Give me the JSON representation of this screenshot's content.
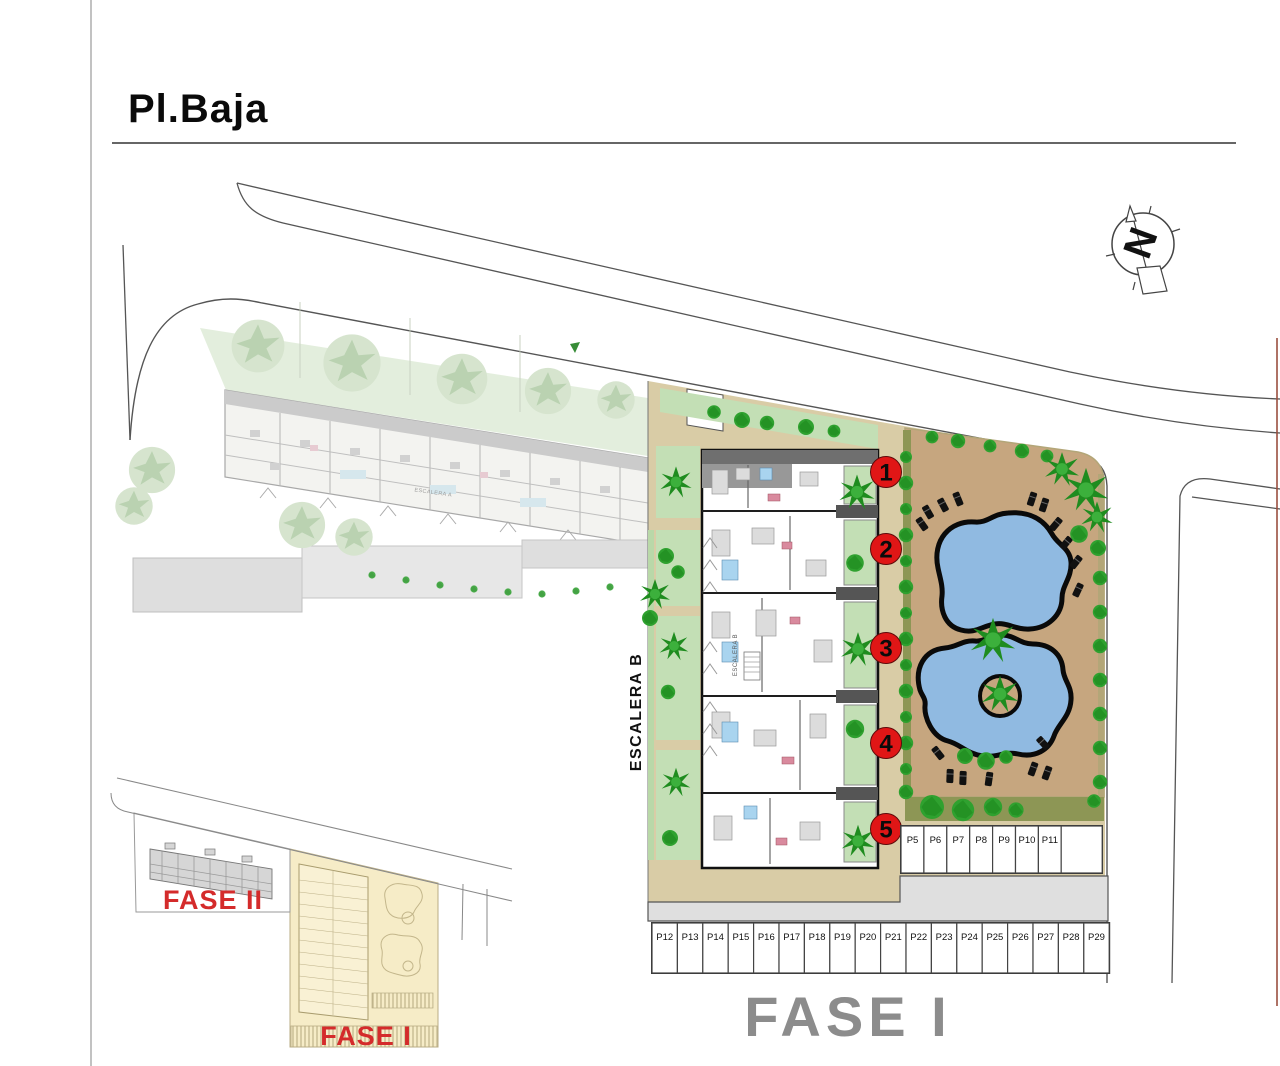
{
  "page": {
    "title": "Pl.Baja"
  },
  "compass": {
    "label": "N"
  },
  "phase": {
    "large_label": "FASE I"
  },
  "building": {
    "stair_label": "ESCALERA B"
  },
  "ghost_building": {
    "stair_label": "ESCALERA A"
  },
  "unit_markers": [
    "1",
    "2",
    "3",
    "4",
    "5"
  ],
  "parking": {
    "row_upper": [
      "P5",
      "P6",
      "P7",
      "P8",
      "P9",
      "P10",
      "P11"
    ],
    "row_lower": [
      "P12",
      "P13",
      "P14",
      "P15",
      "P16",
      "P17",
      "P18",
      "P19",
      "P20",
      "P21",
      "P22",
      "P23",
      "P24",
      "P25",
      "P26",
      "P27",
      "P28",
      "P29"
    ]
  },
  "inset": {
    "fase2_label": "FASE II",
    "fase1_label": "FASE I"
  },
  "colors": {
    "marker_red": "#e01616",
    "phase_label_gray": "#8c8c8c",
    "phase_label_red": "#d42b2b",
    "pool_blue": "#90bae1",
    "path_tan": "#d9cca6",
    "pool_ground_tan": "#c6a67f",
    "garden_green": "#c3dfb5",
    "tree_green": "#2fa12f",
    "hedge_olive": "#8d9655",
    "road_gray": "#dfdfdf"
  }
}
